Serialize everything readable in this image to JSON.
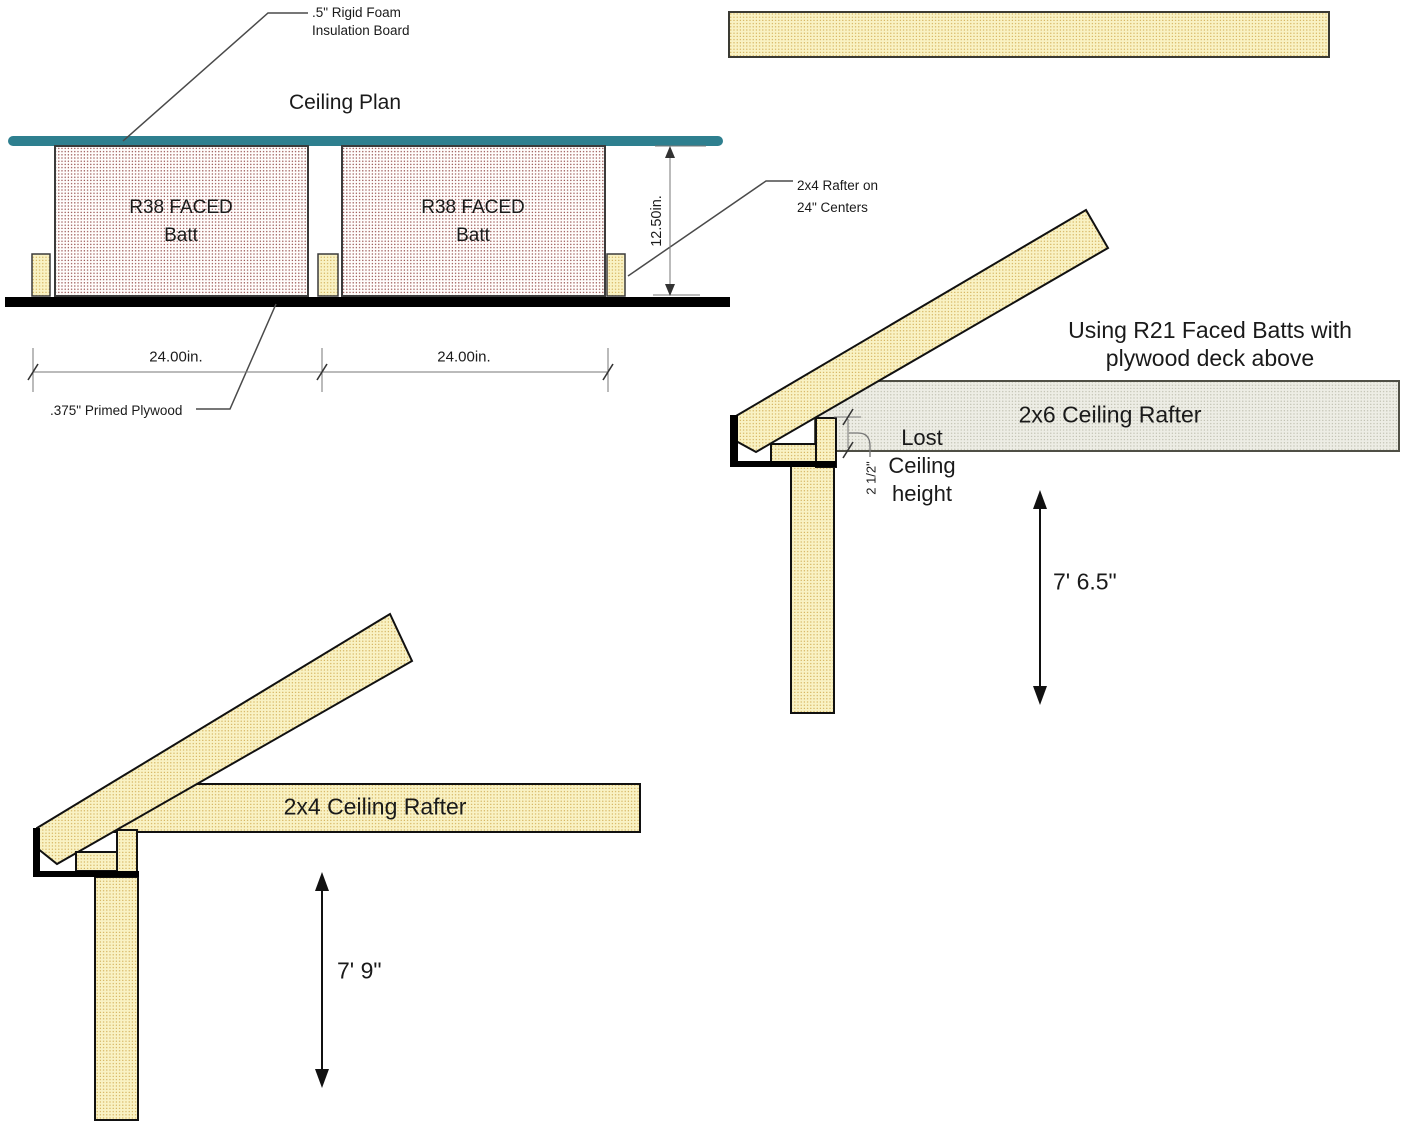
{
  "ceiling_plan": {
    "title": "Ceiling Plan",
    "foam_label": {
      "line1": ".5\" Rigid Foam",
      "line2": "Insulation Board"
    },
    "batt_label": {
      "line1": "R38 FACED",
      "line2": "Batt"
    },
    "rafter_label": {
      "line1": "2x4 Rafter on",
      "line2": "24\" Centers"
    },
    "plywood_label": ".375\" Primed Plywood",
    "dim_width_left": "24.00in.",
    "dim_width_right": "24.00in.",
    "dim_depth": "12.50in."
  },
  "detail_r21": {
    "heading": {
      "line1": "Using R21 Faced Batts with",
      "line2": "plywood deck above"
    },
    "rafter_label": "2x6 Ceiling Rafter",
    "lost_label": {
      "line1": "Lost",
      "line2": "Ceiling",
      "line3": "height"
    },
    "gap_dim": "2 1/2\"",
    "height_dim": "7' 6.5\""
  },
  "detail_r38": {
    "rafter_label": "2x4 Ceiling Rafter",
    "height_dim": "7' 9\""
  },
  "colors": {
    "foam_board_teal": "#2E7F8F",
    "lumber_fill": "#F9F2C4",
    "lumber_dot": "#CFA94F",
    "batt_dot": "#96504E",
    "deck_fill": "#EDEDE5",
    "deck_dot": "#B9B9A8",
    "structure_black": "#000000",
    "dim_line_gray": "#777777"
  }
}
